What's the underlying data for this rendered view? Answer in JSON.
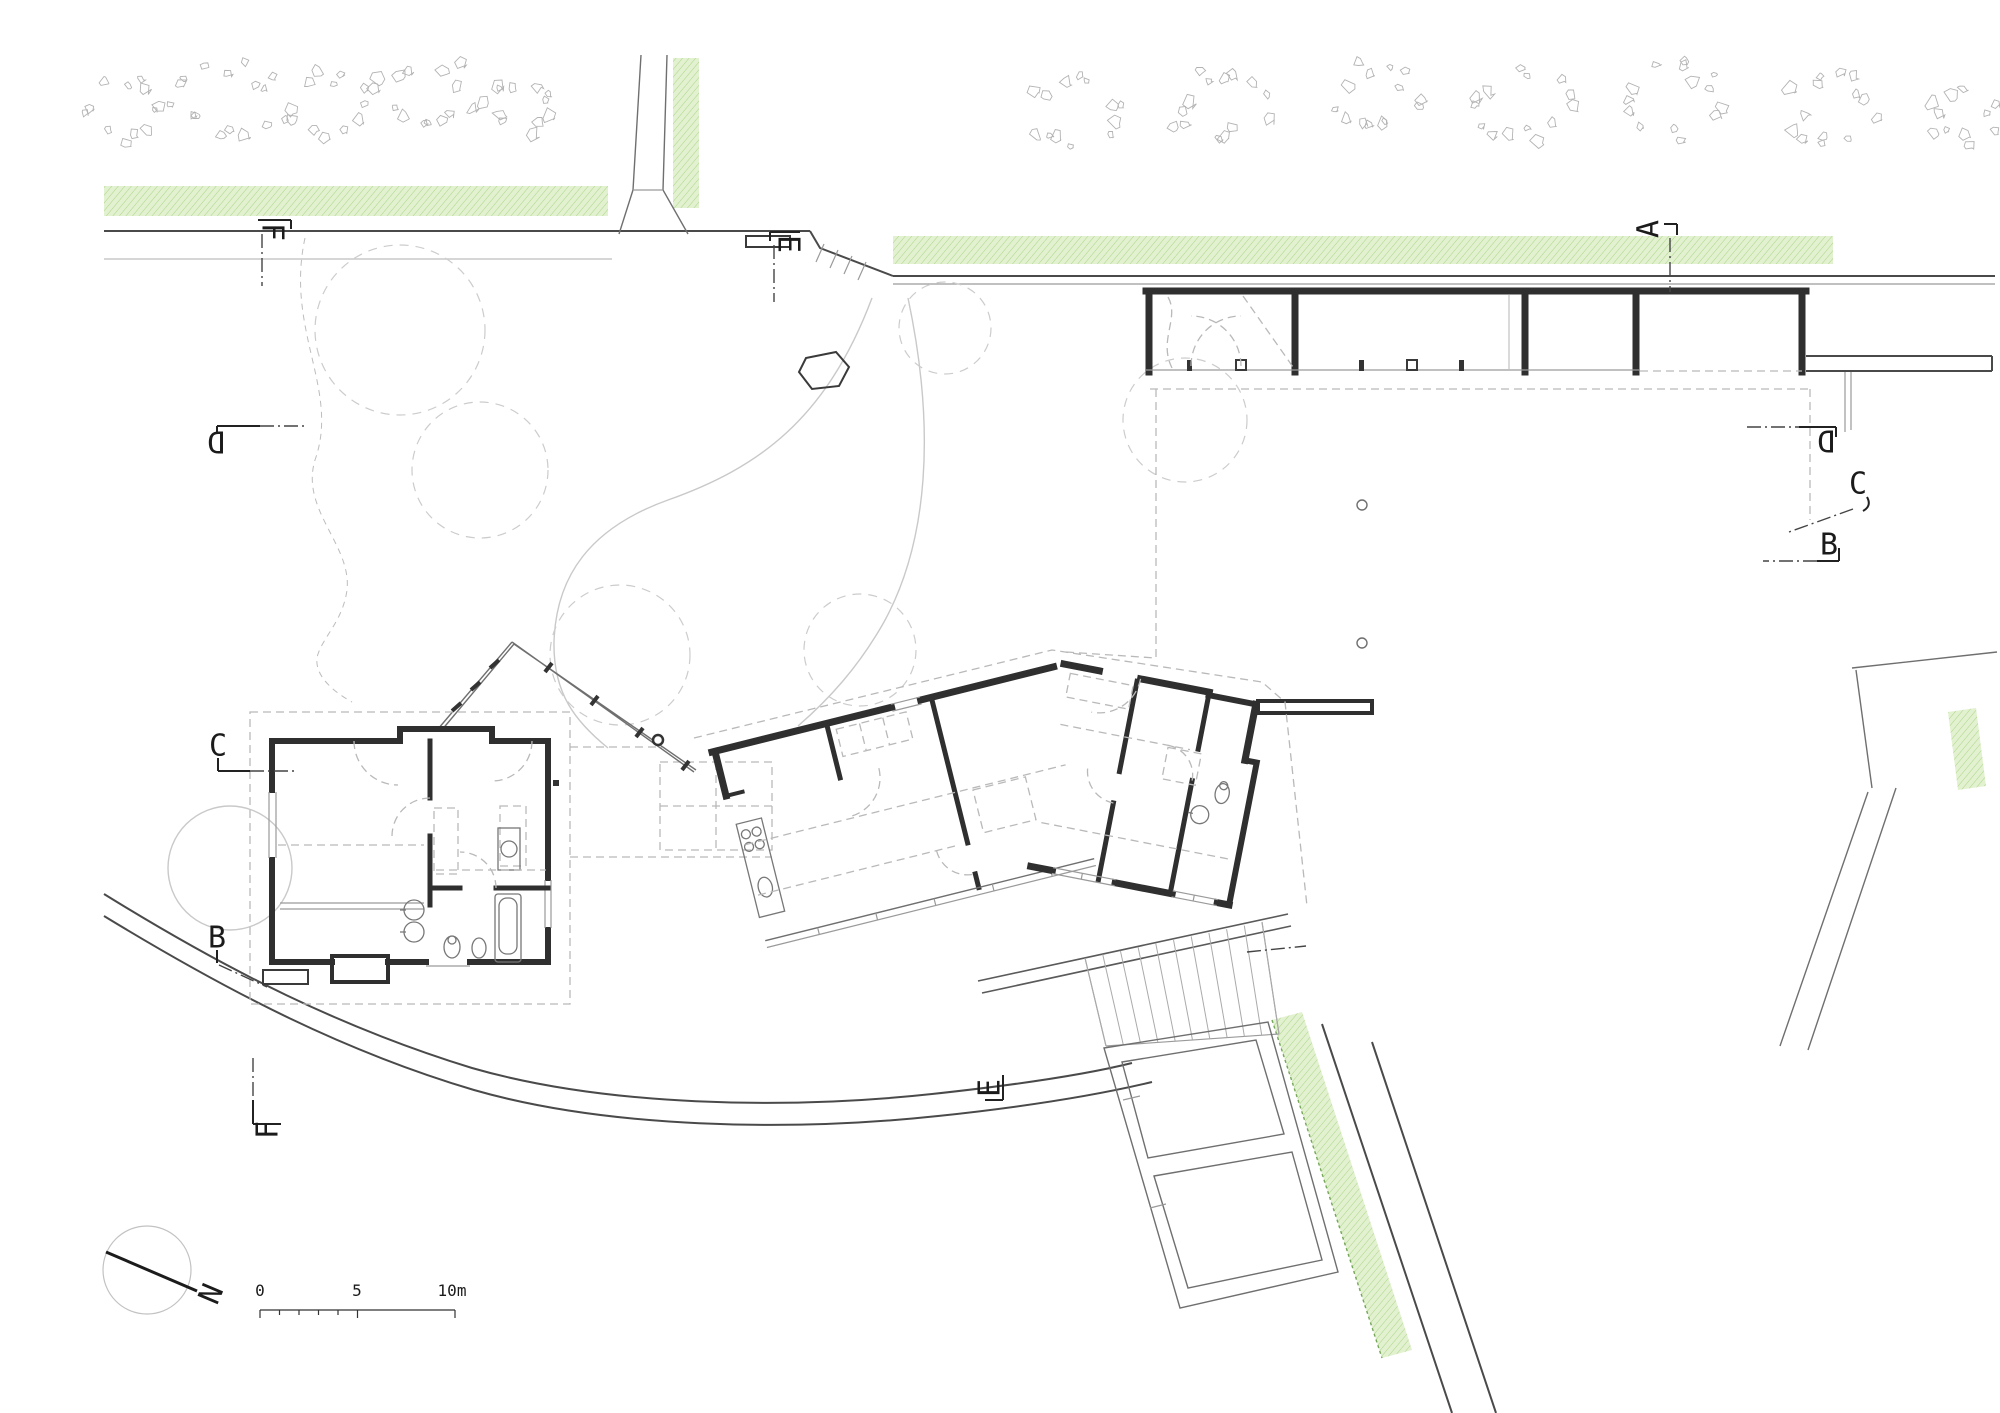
{
  "drawing": {
    "type": "architectural ground-floor site plan",
    "colors": {
      "paper": "#ffffff",
      "wall": "#2f2f2f",
      "road": "#4a4a4a",
      "light_line": "#c9c9c9",
      "dashed_line": "#b9b9b9",
      "green_fill": "#e2f1cf",
      "green_hatch": "#abd488",
      "green_edge_dots": "#76a65a",
      "tree_outline": "#b3b3b3",
      "text": "#1b1b1b"
    }
  },
  "markers": [
    {
      "id": "f-top",
      "label": "F"
    },
    {
      "id": "e-top",
      "label": "E"
    },
    {
      "id": "a-top",
      "label": "A"
    },
    {
      "id": "d-left",
      "label": "D"
    },
    {
      "id": "c-left",
      "label": "C"
    },
    {
      "id": "b-left",
      "label": "B"
    },
    {
      "id": "f-bottom",
      "label": "F"
    },
    {
      "id": "e-bottom",
      "label": "E"
    },
    {
      "id": "d-right",
      "label": "D"
    },
    {
      "id": "c-right",
      "label": "C"
    },
    {
      "id": "b-right",
      "label": "B"
    }
  ],
  "north_label": "N",
  "scale_bar": {
    "labels": [
      "0",
      "5",
      "10m"
    ]
  },
  "landscape": {
    "trees": [
      {
        "cx": 130,
        "cy": 110,
        "r": 50
      },
      {
        "cx": 228,
        "cy": 98,
        "r": 56
      },
      {
        "cx": 328,
        "cy": 106,
        "r": 50
      },
      {
        "cx": 424,
        "cy": 94,
        "r": 56
      },
      {
        "cx": 520,
        "cy": 106,
        "r": 46
      },
      {
        "cx": 1072,
        "cy": 110,
        "r": 52
      },
      {
        "cx": 1220,
        "cy": 106,
        "r": 56
      },
      {
        "cx": 1372,
        "cy": 100,
        "r": 54
      },
      {
        "cx": 1525,
        "cy": 106,
        "r": 54
      },
      {
        "cx": 1676,
        "cy": 100,
        "r": 54
      },
      {
        "cx": 1830,
        "cy": 106,
        "r": 54
      },
      {
        "cx": 1962,
        "cy": 116,
        "r": 42
      }
    ]
  }
}
